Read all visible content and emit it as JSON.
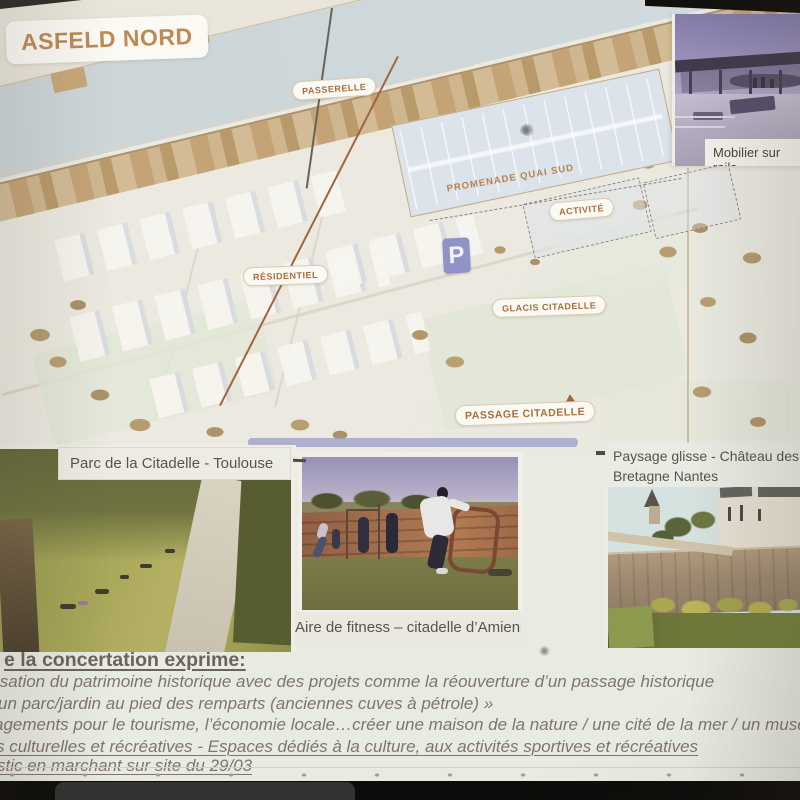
{
  "map": {
    "title": "ASFELD NORD",
    "labels": {
      "passerelle": "PASSERELLE",
      "promenade_quai_sud": "PROMENADE QUAI SUD",
      "activite": "ACTIVITÉ",
      "residentiel": "RÉSIDENTIEL",
      "glacis_citadelle": "GLACIS CITADELLE",
      "passage_citadelle": "PASSAGE CITADELLE",
      "parking": "P"
    }
  },
  "photos": {
    "mobilier_sur_rails": {
      "caption": "Mobilier sur rails"
    },
    "parc_citadelle_toulouse": {
      "caption": "Parc de la Citadelle - Toulouse"
    },
    "aire_fitness_amiens": {
      "caption": "Aire de fitness – citadelle d’Amiens"
    },
    "paysage_glisse_nantes": {
      "caption_line1": "Paysage glisse  - Château des Ducs",
      "caption_line2": "Bretagne Nantes"
    }
  },
  "notes": {
    "heading": "e la concertation exprime:",
    "line1": "isation du patrimoine historique avec des projets comme la réouverture d’un passage historique",
    "line2": "un parc/jardin au pied des remparts (anciennes cuves à pétrole) »",
    "line3": "agements pour le tourisme, l’économie locale…créer une maison de la nature / une cité de la mer / un musée",
    "line4": "s culturelles et récréatives - Espaces dédiés à la culture, aux activités sportives et récréatives",
    "line5": "stic en marchant sur site du 29/03"
  },
  "colors": {
    "map_label_text": "#a8703f",
    "map_title_text": "#bd8a55",
    "map_background": "#ebe9e0",
    "water": "#cfd8da",
    "river_bank": "#cdb38c",
    "parking_icon": "#9093c5",
    "passage_arrow": "#a2643f",
    "caption_text": "#59534c",
    "notes_text": "#80756e"
  }
}
